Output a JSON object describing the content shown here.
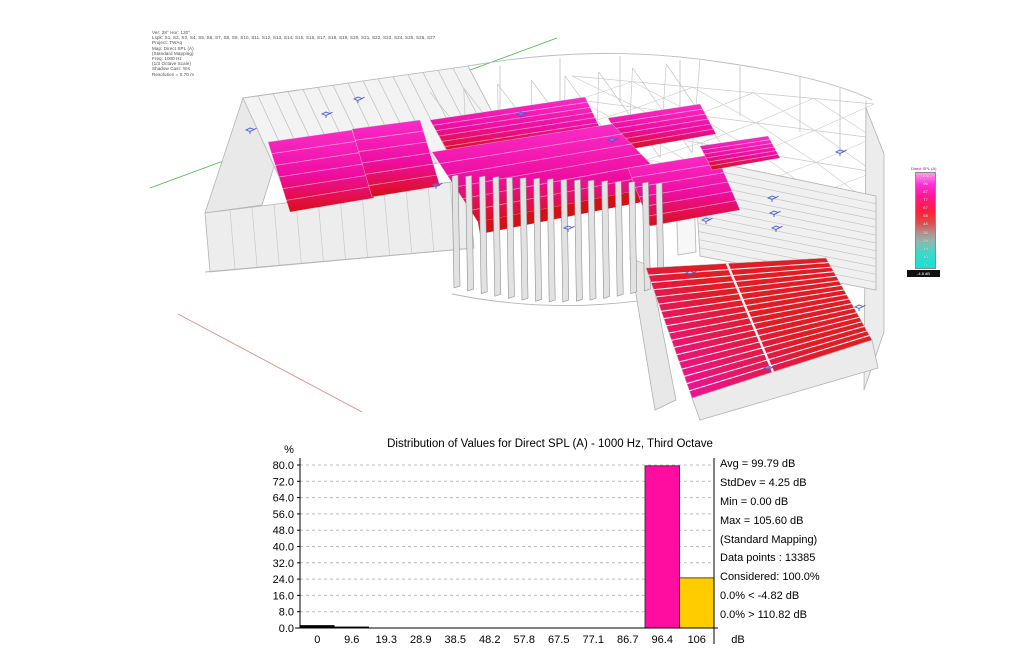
{
  "view3d": {
    "params_lines": [
      "Ver: 28°  Hor: 120°",
      "Lspk: S1, S2, S3, S4, S5, S6, S7, S8, S9, S10, S11, S12, S13, S14, S15, S16, S17, S18, S19, S20, S21, S22, S23, S24, S25, S26, S27",
      "Project: TWAq",
      "Map: Direct SPL (A)",
      "(Standard Mapping)",
      "Freq: 1000 Hz",
      "(1/3 Octave Scale)",
      "Shadow Cast: Yes",
      "Resolution =  0.70 m"
    ],
    "legend": {
      "title": "Direct SPL (A)",
      "unit": "dB",
      "ticks": [
        "106",
        "96",
        "87",
        "77",
        "67",
        "58",
        "48",
        "38",
        "29",
        "19",
        "10",
        "0"
      ],
      "bottom_label": "-4.8 dB"
    }
  },
  "histogram": {
    "title": "Distribution of Values for Direct SPL (A) - 1000 Hz, Third Octave",
    "stats_primary": [
      "Avg = 99.79 dB",
      "StdDev = 4.25 dB",
      "Min = 0.00 dB",
      "Max = 105.60 dB",
      "(Standard Mapping)"
    ],
    "stats_secondary": [
      "Data points : 13385",
      "Considered: 100.0%",
      "0.0%  < -4.82 dB",
      "0.0%  > 110.82 dB"
    ]
  },
  "chart_data": {
    "type": "bar",
    "title": "Distribution of Values for Direct SPL (A) - 1000 Hz, Third Octave",
    "categories": [
      "0",
      "9.6",
      "19.3",
      "28.9",
      "38.5",
      "48.2",
      "57.8",
      "67.5",
      "77.1",
      "86.7",
      "96.4",
      "106"
    ],
    "values": [
      1.4,
      0.7,
      0,
      0,
      0,
      0,
      0,
      0,
      0,
      0,
      79.6,
      24.6
    ],
    "bar_colors": [
      "#000000",
      "#000000",
      "#000000",
      "#000000",
      "#000000",
      "#000000",
      "#000000",
      "#000000",
      "#000000",
      "#000000",
      "#ff0da0",
      "#ffcc00"
    ],
    "xlabel": "dB",
    "ylabel": "%",
    "ylim": [
      0,
      80
    ],
    "yticks": [
      0,
      8,
      16,
      24,
      32,
      40,
      48,
      56,
      64,
      72,
      80
    ],
    "grid": "horizontal-dashed",
    "legend_position": "none"
  },
  "colors": {
    "audience_top": "#fb2cc8",
    "audience_mid": "#ee0da0",
    "audience_low": "#e00f3a",
    "audience_bottom": "#d40f16",
    "tribune_left": "#f010b0",
    "tribune_right": "#e01c24",
    "bar_magenta": "#ff0da0",
    "bar_yellow": "#ffcc00",
    "wireframe": "#c0c0c0",
    "speaker_blue": "#4a5ad0",
    "axis_green": "#44bb44",
    "axis_red": "#dd8888"
  }
}
